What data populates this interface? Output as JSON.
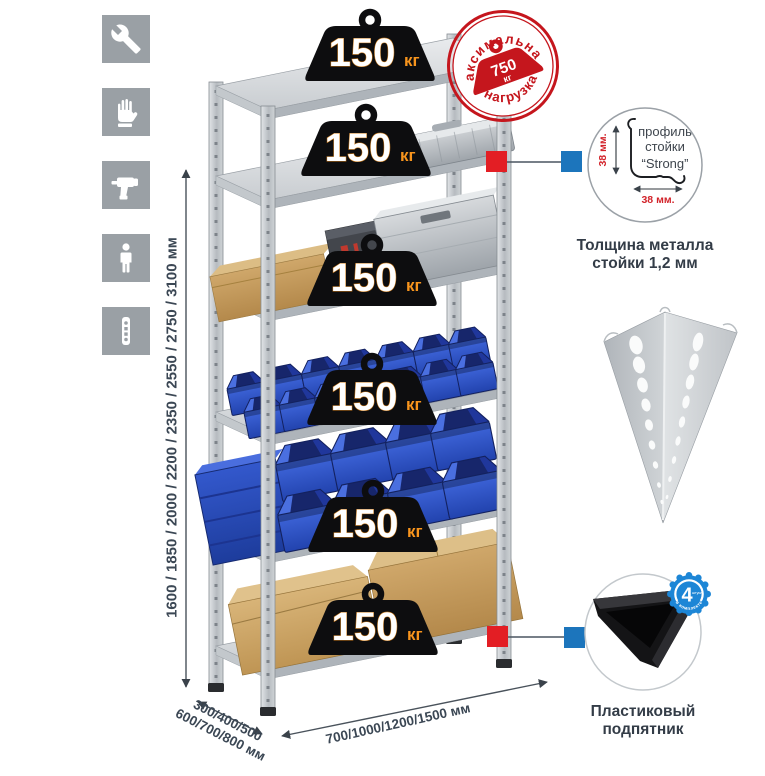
{
  "icon_strip": {
    "tile_color": "#9aa0a5",
    "icons": [
      {
        "name": "wrench-icon"
      },
      {
        "name": "work-gloves-icon"
      },
      {
        "name": "drill-icon"
      },
      {
        "name": "person-icon"
      },
      {
        "name": "post-profile-icon"
      }
    ]
  },
  "rack": {
    "shelf_count": 6,
    "shelf_load": {
      "value": "150",
      "unit": "кг"
    }
  },
  "max_load_stamp": {
    "arc_top": "максимальная",
    "arc_bottom": "нагрузка",
    "value": "750",
    "unit": "кг",
    "color": "#c5161d"
  },
  "dimensions": {
    "height": "1600 / 1850 / 2000 / 2200 / 2350 / 2550 / 2750 / 3100 мм",
    "depth_line1": "300/400/500",
    "depth_line2": "600/700/800 мм",
    "width": "700/1000/1200/1500 мм"
  },
  "profile_detail": {
    "label_line1": "профиль",
    "label_line2": "стойки",
    "label_line3": "“Strong”",
    "dim_side": "38 мм.",
    "dim_bottom": "38 мм.",
    "caption_line1": "Толщина металла",
    "caption_line2": "стойки 1,2 мм"
  },
  "foot_detail": {
    "badge_value": "4",
    "badge_small_text": "штуки",
    "badge_arc_text": "в комплекте",
    "caption_line1": "Пластиковый",
    "caption_line2": "подпятник"
  },
  "colors": {
    "accent_red": "#e31e24",
    "accent_blue": "#1c75bc",
    "badge_black": "#0d0d0f",
    "load_unit_orange": "#f7941d",
    "bin_blue": "#2e56c9",
    "text_dark": "#3b4754"
  }
}
